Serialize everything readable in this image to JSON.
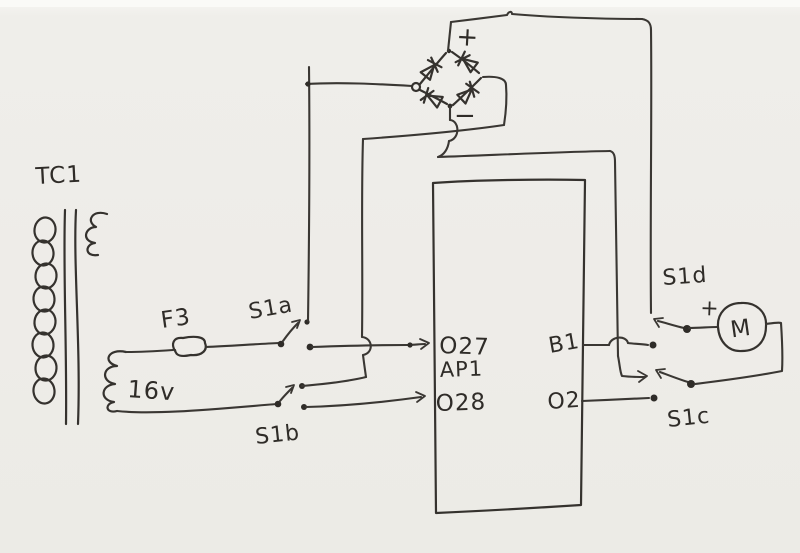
{
  "diagram": {
    "description": "Hand-drawn circuit schematic (scanned pen sketch): transformer, fuse, changeover switches, bridge rectifier, controller block and motor",
    "ink_color": "#3a3733",
    "paper_color": "#eeece8",
    "transformer": {
      "name": "TC1",
      "secondary_voltage": "16v"
    },
    "fuse": {
      "name": "F3"
    },
    "switches": {
      "a": "S1a",
      "b": "S1b",
      "c": "S1c",
      "d": "S1d"
    },
    "bridge": {
      "plus": "+",
      "minus": "−"
    },
    "controller": {
      "input_top": "O27",
      "name": "AP1",
      "input_bottom": "O28",
      "output_top": "B1",
      "output_bottom": "O2"
    },
    "motor": {
      "name": "M",
      "plus": "+"
    }
  }
}
